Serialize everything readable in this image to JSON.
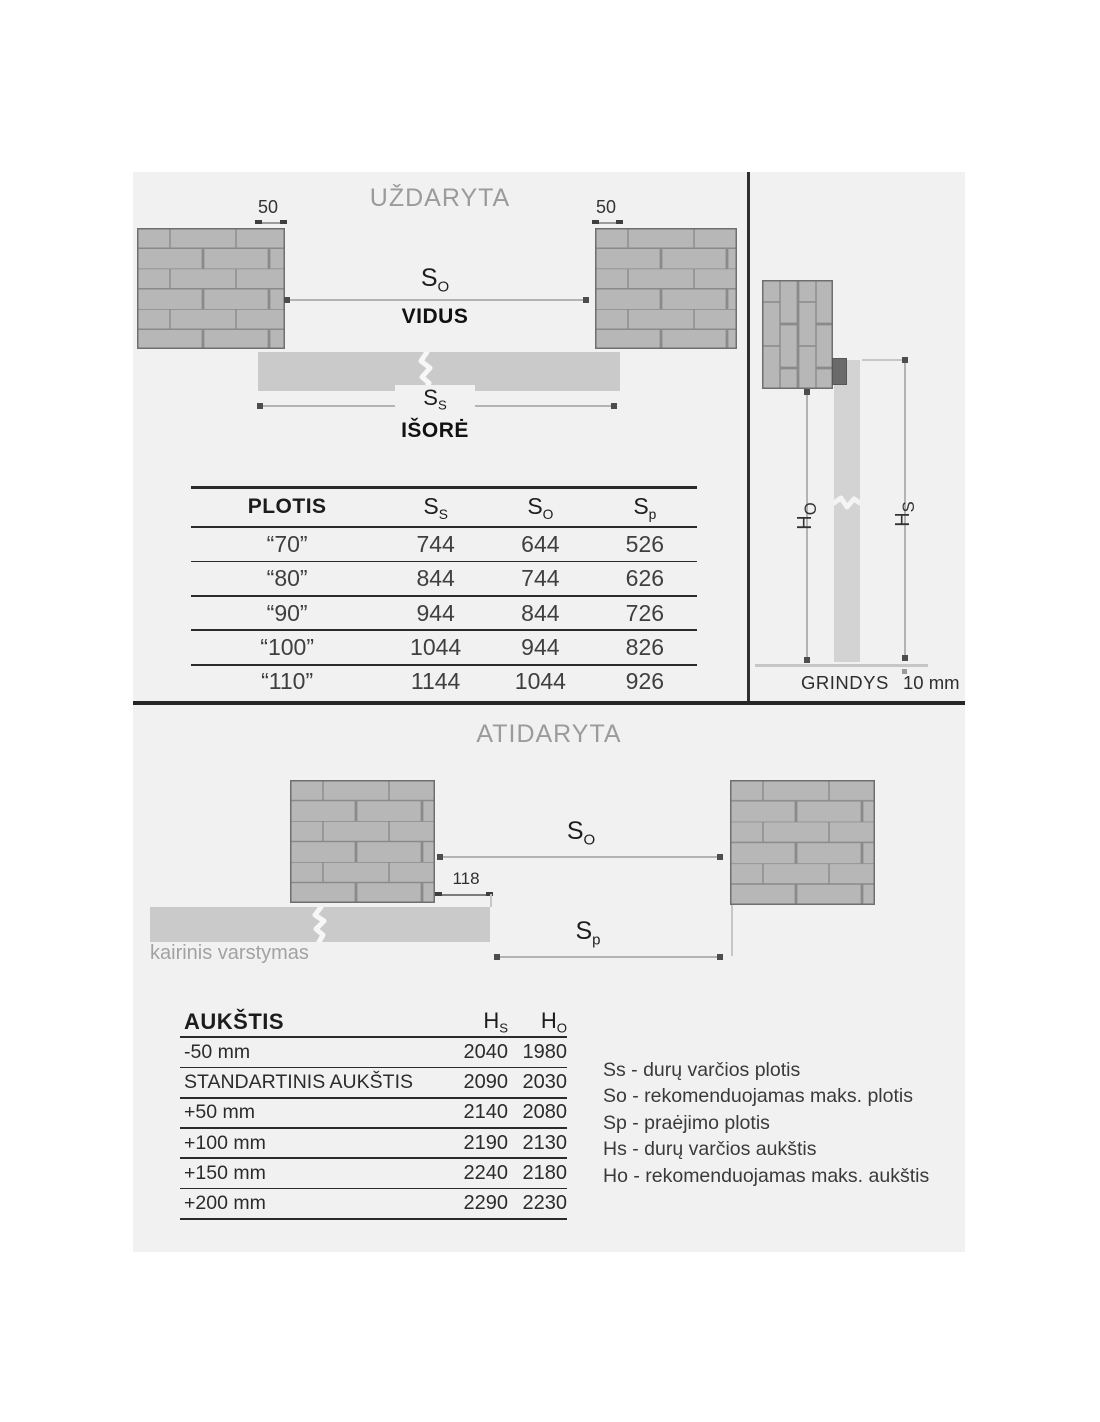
{
  "colors": {
    "canvas_bg": "#f1f1f1",
    "page_bg": "#ffffff",
    "brick_fill": "#b7b7b7",
    "brick_joint": "#8a8a8a",
    "door_fill": "#cacaca",
    "track_block": "#6a6a6a",
    "dim_line": "#b3b3b3",
    "title_gray": "#9b9b9b"
  },
  "closed_section": {
    "title": "UŽDARYTA",
    "wall_offset_left": "50",
    "wall_offset_right": "50",
    "so_label": {
      "main": "S",
      "sub": "O"
    },
    "inside_label": "VIDUS",
    "ss_label": {
      "main": "S",
      "sub": "S"
    },
    "outside_label": "IŠORĖ"
  },
  "plotis_table": {
    "title_header": "PLOTIS",
    "headers": [
      {
        "main": "S",
        "sub": "S"
      },
      {
        "main": "S",
        "sub": "O"
      },
      {
        "main": "S",
        "sub": "p"
      }
    ],
    "rows": [
      {
        "label": "“70”",
        "ss": "744",
        "so": "644",
        "sp": "526"
      },
      {
        "label": "“80”",
        "ss": "844",
        "so": "744",
        "sp": "626"
      },
      {
        "label": "“90”",
        "ss": "944",
        "so": "844",
        "sp": "726"
      },
      {
        "label": "“100”",
        "ss": "1044",
        "so": "944",
        "sp": "826"
      },
      {
        "label": "“110”",
        "ss": "1144",
        "so": "1044",
        "sp": "926"
      }
    ]
  },
  "section_view": {
    "ho_label": {
      "main": "H",
      "sub": "O"
    },
    "hs_label": {
      "main": "H",
      "sub": "S"
    },
    "floor_label": "GRINDYS",
    "floor_gap": "10 mm"
  },
  "open_section": {
    "title": "ATIDARYTA",
    "so_label": {
      "main": "S",
      "sub": "O"
    },
    "sp_label": {
      "main": "S",
      "sub": "p"
    },
    "overlap_dim": "118",
    "swing_label": "kairinis varstymas"
  },
  "aukstis_table": {
    "title_header": "AUKŠTIS",
    "headers": [
      {
        "main": "H",
        "sub": "S"
      },
      {
        "main": "H",
        "sub": "O"
      }
    ],
    "rows": [
      {
        "label": "-50 mm",
        "hs": "2040",
        "ho": "1980"
      },
      {
        "label": "STANDARTINIS AUKŠTIS",
        "hs": "2090",
        "ho": "2030"
      },
      {
        "label": "+50 mm",
        "hs": "2140",
        "ho": "2080"
      },
      {
        "label": "+100 mm",
        "hs": "2190",
        "ho": "2130"
      },
      {
        "label": "+150 mm",
        "hs": "2240",
        "ho": "2180"
      },
      {
        "label": "+200 mm",
        "hs": "2290",
        "ho": "2230"
      }
    ]
  },
  "legend": {
    "items": [
      "Ss - durų varčios plotis",
      "So - rekomenduojamas maks. plotis",
      "Sp - praėjimo plotis",
      "Hs - durų varčios aukštis",
      "Ho - rekomenduojamas maks. aukštis"
    ]
  }
}
